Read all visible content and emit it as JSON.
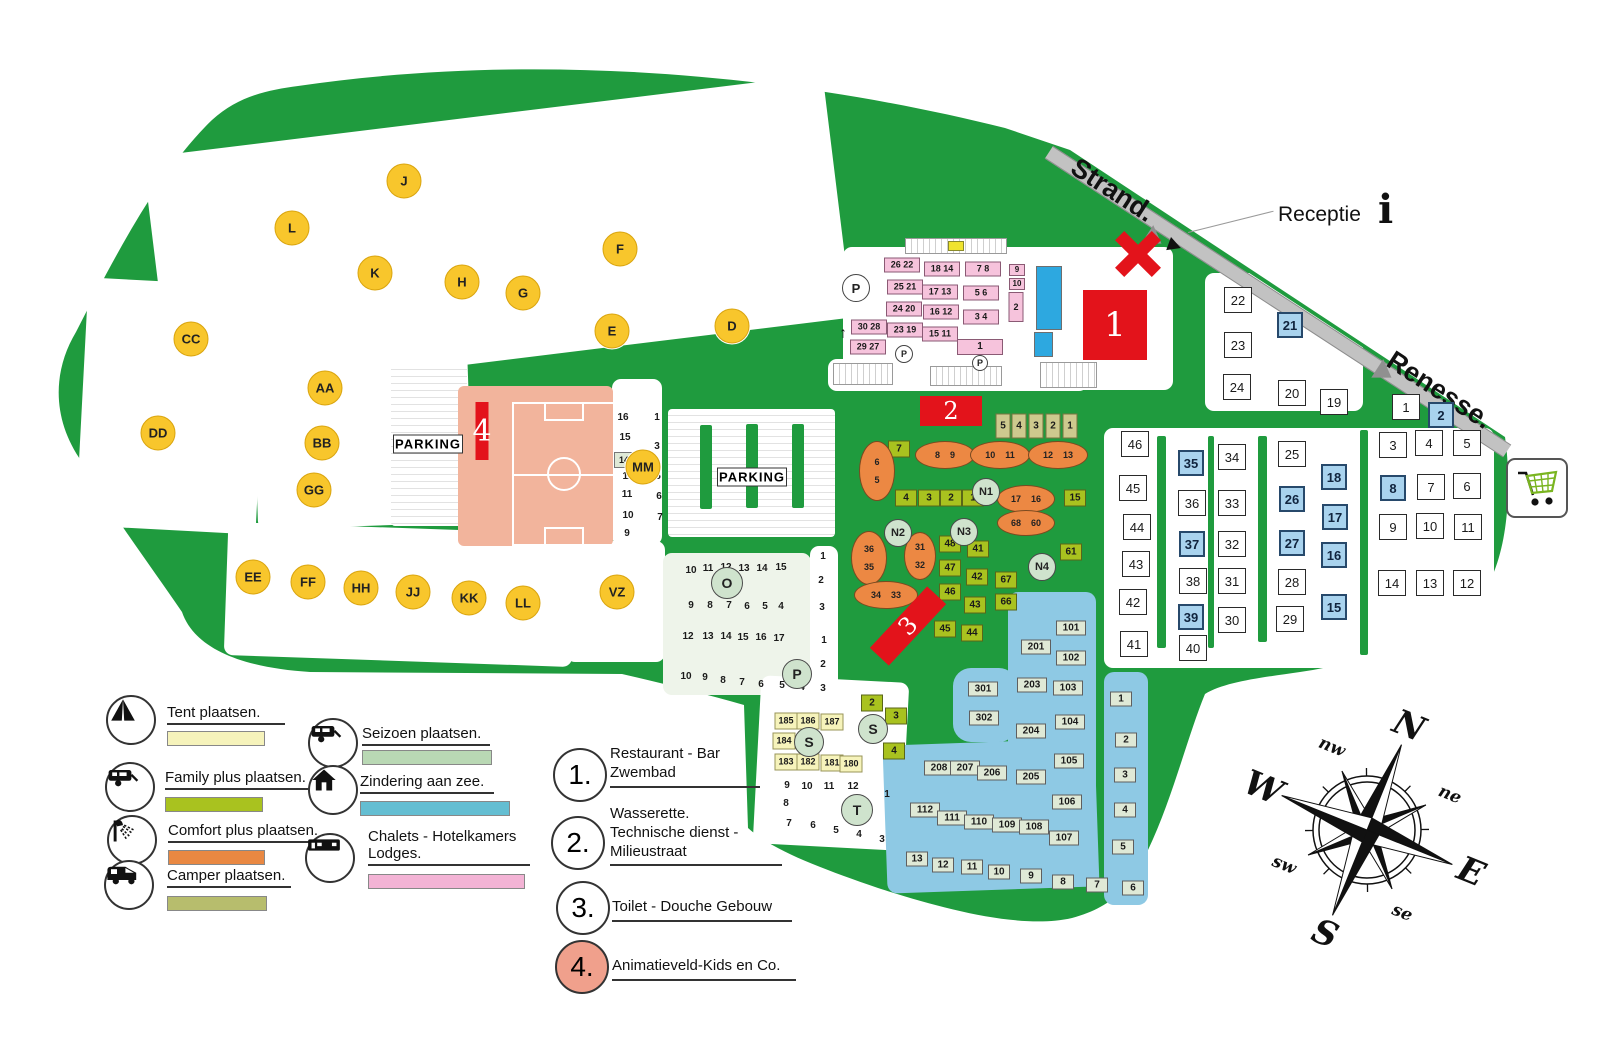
{
  "map": {
    "road_labels": {
      "strand": "Strand.",
      "renesse": "Renesse.",
      "receptie": "Receptie",
      "info_icon": "i"
    },
    "parking_label": "PARKING",
    "up_arrow": "↑",
    "zone_circles": [
      [
        "J",
        404,
        181
      ],
      [
        "L",
        292,
        228
      ],
      [
        "K",
        375,
        273
      ],
      [
        "F",
        620,
        249
      ],
      [
        "H",
        462,
        282
      ],
      [
        "G",
        523,
        293
      ],
      [
        "E",
        612,
        331
      ],
      [
        "D",
        732,
        326
      ],
      [
        "CC",
        191,
        339
      ],
      [
        "AA",
        325,
        388
      ],
      [
        "DD",
        158,
        433
      ],
      [
        "BB",
        322,
        443
      ],
      [
        "GG",
        314,
        490
      ],
      [
        "MM",
        643,
        467
      ],
      [
        "EE",
        253,
        577
      ],
      [
        "FF",
        308,
        582
      ],
      [
        "HH",
        361,
        588
      ],
      [
        "JJ",
        413,
        592
      ],
      [
        "KK",
        469,
        598
      ],
      [
        "LL",
        523,
        603
      ],
      [
        "VZ",
        617,
        592
      ]
    ],
    "green_circles": [
      [
        "O",
        727,
        583,
        30
      ],
      [
        "P",
        797,
        674,
        28
      ],
      [
        "S",
        809,
        742,
        28
      ],
      [
        "S",
        873,
        729,
        28
      ],
      [
        "T",
        857,
        810,
        30
      ],
      [
        "N1",
        986,
        492,
        26
      ],
      [
        "N2",
        898,
        533,
        26
      ],
      [
        "N3",
        964,
        532,
        26
      ],
      [
        "N4",
        1042,
        567,
        26
      ]
    ],
    "white_p_circles": [
      [
        856,
        288,
        26
      ],
      [
        904,
        354,
        16
      ],
      [
        980,
        363,
        14
      ]
    ],
    "plots": [
      [
        "w",
        1238,
        300,
        "22"
      ],
      [
        "w",
        1238,
        345,
        "23"
      ],
      [
        "w",
        1237,
        387,
        "24"
      ],
      [
        "b",
        1290,
        325,
        "21"
      ],
      [
        "w",
        1292,
        393,
        "20"
      ],
      [
        "w",
        1334,
        402,
        "19"
      ],
      [
        "w",
        1406,
        407,
        "1"
      ],
      [
        "b",
        1441,
        415,
        "2"
      ],
      [
        "w",
        1135,
        444,
        "46"
      ],
      [
        "w",
        1133,
        488,
        "45"
      ],
      [
        "w",
        1137,
        527,
        "44"
      ],
      [
        "w",
        1136,
        564,
        "43"
      ],
      [
        "w",
        1133,
        602,
        "42"
      ],
      [
        "w",
        1134,
        644,
        "41"
      ],
      [
        "b",
        1191,
        463,
        "35"
      ],
      [
        "w",
        1192,
        503,
        "36"
      ],
      [
        "b",
        1192,
        544,
        "37"
      ],
      [
        "w",
        1193,
        581,
        "38"
      ],
      [
        "b",
        1191,
        617,
        "39"
      ],
      [
        "w",
        1193,
        648,
        "40"
      ],
      [
        "w",
        1232,
        457,
        "34"
      ],
      [
        "w",
        1232,
        503,
        "33"
      ],
      [
        "w",
        1232,
        544,
        "32"
      ],
      [
        "w",
        1232,
        581,
        "31"
      ],
      [
        "w",
        1232,
        620,
        "30"
      ],
      [
        "w",
        1292,
        454,
        "25"
      ],
      [
        "b",
        1292,
        499,
        "26"
      ],
      [
        "b",
        1292,
        543,
        "27"
      ],
      [
        "w",
        1292,
        582,
        "28"
      ],
      [
        "w",
        1290,
        619,
        "29"
      ],
      [
        "b",
        1334,
        477,
        "18"
      ],
      [
        "b",
        1335,
        517,
        "17"
      ],
      [
        "b",
        1334,
        555,
        "16"
      ],
      [
        "b",
        1334,
        607,
        "15"
      ],
      [
        "w",
        1393,
        445,
        "3"
      ],
      [
        "w",
        1429,
        443,
        "4"
      ],
      [
        "w",
        1467,
        443,
        "5"
      ],
      [
        "b",
        1393,
        488,
        "8"
      ],
      [
        "w",
        1431,
        487,
        "7"
      ],
      [
        "w",
        1467,
        486,
        "6"
      ],
      [
        "w",
        1393,
        527,
        "9"
      ],
      [
        "w",
        1430,
        526,
        "10"
      ],
      [
        "w",
        1468,
        527,
        "11"
      ],
      [
        "w",
        1392,
        583,
        "14"
      ],
      [
        "w",
        1430,
        583,
        "13"
      ],
      [
        "w",
        1467,
        583,
        "12"
      ],
      [
        "z",
        1071,
        628,
        "101"
      ],
      [
        "z",
        1071,
        658,
        "102"
      ],
      [
        "z",
        1068,
        688,
        "103"
      ],
      [
        "z",
        1070,
        722,
        "104"
      ],
      [
        "z",
        1069,
        761,
        "105"
      ],
      [
        "z",
        1067,
        802,
        "106"
      ],
      [
        "z",
        1064,
        838,
        "107"
      ],
      [
        "z",
        1036,
        647,
        "201"
      ],
      [
        "z",
        1032,
        685,
        "203"
      ],
      [
        "z",
        1031,
        731,
        "204"
      ],
      [
        "z",
        1031,
        777,
        "205"
      ],
      [
        "z",
        983,
        689,
        "301"
      ],
      [
        "z",
        984,
        718,
        "302"
      ],
      [
        "z",
        939,
        768,
        "208"
      ],
      [
        "z",
        965,
        768,
        "207"
      ],
      [
        "z",
        992,
        773,
        "206"
      ],
      [
        "z",
        925,
        810,
        "112"
      ],
      [
        "z",
        952,
        818,
        "111"
      ],
      [
        "z",
        979,
        822,
        "110"
      ],
      [
        "z",
        1007,
        825,
        "109"
      ],
      [
        "z",
        1034,
        827,
        "108"
      ],
      [
        "z",
        917,
        859,
        "13"
      ],
      [
        "z",
        943,
        865,
        "12"
      ],
      [
        "z",
        972,
        867,
        "11"
      ],
      [
        "z",
        999,
        872,
        "10"
      ],
      [
        "z",
        1031,
        876,
        "9"
      ],
      [
        "z",
        1063,
        882,
        "8"
      ],
      [
        "z",
        1097,
        885,
        "7"
      ],
      [
        "z",
        1133,
        888,
        "6"
      ],
      [
        "z",
        1121,
        699,
        "1"
      ],
      [
        "z",
        1126,
        740,
        "2"
      ],
      [
        "z",
        1125,
        775,
        "3"
      ],
      [
        "z",
        1125,
        810,
        "4"
      ],
      [
        "z",
        1123,
        847,
        "5"
      ],
      [
        "k",
        902,
        265,
        "26 22"
      ],
      [
        "k",
        905,
        287,
        "25 21"
      ],
      [
        "k",
        904,
        309,
        "24 20"
      ],
      [
        "k",
        905,
        330,
        "23 19"
      ],
      [
        "k",
        869,
        327,
        "30 28"
      ],
      [
        "k",
        868,
        347,
        "29 27"
      ],
      [
        "k",
        942,
        269,
        "18 14"
      ],
      [
        "k",
        940,
        292,
        "17 13"
      ],
      [
        "k",
        941,
        312,
        "16 12"
      ],
      [
        "k",
        940,
        334,
        "15 11"
      ],
      [
        "k",
        983,
        269,
        "7 8"
      ],
      [
        "k",
        981,
        293,
        "5 6"
      ],
      [
        "k",
        981,
        317,
        "3 4"
      ],
      [
        "k1",
        980,
        347,
        "1"
      ],
      [
        "k2",
        1017,
        270,
        "9"
      ],
      [
        "k2",
        1017,
        284,
        "10"
      ],
      [
        "k3",
        1016,
        307,
        "2"
      ],
      [
        "g",
        899,
        449,
        "7"
      ],
      [
        "g",
        906,
        498,
        "4"
      ],
      [
        "g",
        929,
        498,
        "3"
      ],
      [
        "g",
        951,
        498,
        "2"
      ],
      [
        "g",
        973,
        498,
        "1"
      ],
      [
        "g",
        1075,
        498,
        "15"
      ],
      [
        "g",
        1071,
        552,
        "61"
      ],
      [
        "g",
        1006,
        580,
        "67"
      ],
      [
        "g",
        1006,
        602,
        "66"
      ],
      [
        "g",
        950,
        544,
        "48"
      ],
      [
        "g",
        950,
        568,
        "47"
      ],
      [
        "g",
        950,
        592,
        "46"
      ],
      [
        "g",
        978,
        549,
        "41"
      ],
      [
        "g",
        977,
        577,
        "42"
      ],
      [
        "g",
        975,
        605,
        "43"
      ],
      [
        "g",
        972,
        633,
        "44"
      ],
      [
        "g",
        945,
        629,
        "45"
      ],
      [
        "g",
        872,
        703,
        "2"
      ],
      [
        "g",
        896,
        716,
        "3"
      ],
      [
        "g",
        894,
        751,
        "4"
      ],
      [
        "t",
        1003,
        426,
        "5"
      ],
      [
        "t",
        1019,
        426,
        "4"
      ],
      [
        "t",
        1036,
        426,
        "3"
      ],
      [
        "t",
        1053,
        426,
        "2"
      ],
      [
        "t",
        1070,
        426,
        "1"
      ],
      [
        "y",
        786,
        721,
        "185"
      ],
      [
        "y",
        808,
        721,
        "186"
      ],
      [
        "y",
        832,
        722,
        "187"
      ],
      [
        "y",
        784,
        741,
        "184"
      ],
      [
        "y",
        786,
        762,
        "183"
      ],
      [
        "y",
        808,
        762,
        "182"
      ],
      [
        "y",
        832,
        763,
        "181"
      ],
      [
        "y",
        851,
        764,
        "180"
      ],
      [
        "n",
        691,
        571,
        "10"
      ],
      [
        "n",
        708,
        569,
        "11"
      ],
      [
        "n",
        726,
        568,
        "12"
      ],
      [
        "n",
        744,
        569,
        "13"
      ],
      [
        "n",
        762,
        569,
        "14"
      ],
      [
        "n",
        781,
        568,
        "15"
      ],
      [
        "n",
        691,
        606,
        "9"
      ],
      [
        "n",
        710,
        606,
        "8"
      ],
      [
        "n",
        729,
        606,
        "7"
      ],
      [
        "n",
        747,
        607,
        "6"
      ],
      [
        "n",
        765,
        607,
        "5"
      ],
      [
        "n",
        781,
        607,
        "4"
      ],
      [
        "n",
        688,
        637,
        "12"
      ],
      [
        "n",
        708,
        637,
        "13"
      ],
      [
        "n",
        726,
        637,
        "14"
      ],
      [
        "n",
        743,
        638,
        "15"
      ],
      [
        "n",
        761,
        638,
        "16"
      ],
      [
        "n",
        779,
        639,
        "17"
      ],
      [
        "n",
        686,
        677,
        "10"
      ],
      [
        "n",
        705,
        678,
        "9"
      ],
      [
        "n",
        723,
        681,
        "8"
      ],
      [
        "n",
        742,
        683,
        "7"
      ],
      [
        "n",
        761,
        685,
        "6"
      ],
      [
        "n",
        782,
        686,
        "5"
      ],
      [
        "n",
        802,
        688,
        "4"
      ],
      [
        "n",
        823,
        557,
        "1"
      ],
      [
        "n",
        821,
        581,
        "2"
      ],
      [
        "n",
        822,
        608,
        "3"
      ],
      [
        "n",
        824,
        641,
        "1"
      ],
      [
        "n",
        823,
        665,
        "2"
      ],
      [
        "n",
        823,
        689,
        "3"
      ],
      [
        "n",
        787,
        786,
        "9"
      ],
      [
        "n",
        807,
        787,
        "10"
      ],
      [
        "n",
        829,
        787,
        "11"
      ],
      [
        "n",
        853,
        787,
        "12"
      ],
      [
        "n",
        887,
        795,
        "1"
      ],
      [
        "n",
        786,
        804,
        "8"
      ],
      [
        "n",
        789,
        824,
        "7"
      ],
      [
        "n",
        813,
        826,
        "6"
      ],
      [
        "n",
        836,
        831,
        "5"
      ],
      [
        "n",
        859,
        835,
        "4"
      ],
      [
        "n",
        882,
        840,
        "3"
      ],
      [
        "n",
        623,
        418,
        "16"
      ],
      [
        "n",
        625,
        438,
        "15"
      ],
      [
        "n",
        628,
        477,
        "12"
      ],
      [
        "n",
        627,
        495,
        "11"
      ],
      [
        "n",
        628,
        516,
        "10"
      ],
      [
        "n",
        627,
        534,
        "9"
      ],
      [
        "n",
        657,
        418,
        "1"
      ],
      [
        "n",
        657,
        447,
        "3"
      ],
      [
        "n",
        658,
        477,
        "5"
      ],
      [
        "n",
        659,
        497,
        "6"
      ],
      [
        "n",
        660,
        518,
        "7"
      ],
      [
        "s",
        624,
        460,
        "14"
      ]
    ],
    "ovals": [
      [
        877,
        471,
        34,
        58,
        1,
        [
          "6",
          "5"
        ]
      ],
      [
        945,
        455,
        58,
        26,
        0,
        [
          "8",
          "9"
        ]
      ],
      [
        1000,
        455,
        58,
        26,
        0,
        [
          "10",
          "11"
        ]
      ],
      [
        1058,
        455,
        58,
        26,
        0,
        [
          "12",
          "13"
        ]
      ],
      [
        1026,
        499,
        56,
        26,
        0,
        [
          "17",
          "16"
        ]
      ],
      [
        1026,
        523,
        56,
        24,
        0,
        [
          "68",
          "60"
        ]
      ],
      [
        869,
        558,
        34,
        52,
        1,
        [
          "36",
          "35"
        ]
      ],
      [
        920,
        556,
        30,
        46,
        1,
        [
          "31",
          "32"
        ]
      ],
      [
        886,
        595,
        62,
        26,
        0,
        [
          "34",
          "33"
        ]
      ]
    ],
    "buildings": [
      {
        "cx": 1115,
        "cy": 325,
        "w": 64,
        "h": 70,
        "rot": 0,
        "label": "1",
        "fs": 34
      },
      {
        "cx": 951,
        "cy": 411,
        "w": 62,
        "h": 30,
        "rot": 0,
        "label": "2",
        "fs": 24
      },
      {
        "cx": 908,
        "cy": 626,
        "w": 84,
        "h": 26,
        "rot": -47,
        "label": "3",
        "fs": 24
      },
      {
        "cx": 482,
        "cy": 431,
        "w": 13,
        "h": 58,
        "rot": 0,
        "label": "4",
        "fs": 30
      }
    ]
  },
  "legend": {
    "items": [
      {
        "icon": "tent-icon",
        "label": "Tent plaatsen.",
        "color": "#f6f3bb",
        "cx": 131,
        "cy": 720,
        "lx": 167,
        "ly": 704,
        "sx": 167,
        "sy": 731,
        "sw": 96,
        "ul": 118
      },
      {
        "icon": "caravan-icon",
        "label": "Family plus plaatsen.",
        "color": "#a9c21f",
        "cx": 130,
        "cy": 787,
        "lx": 165,
        "ly": 769,
        "sx": 165,
        "sy": 797,
        "sw": 96,
        "ul": 152
      },
      {
        "icon": "shower-icon",
        "label": "Comfort plus plaatsen.",
        "color": "#e98842",
        "cx": 132,
        "cy": 840,
        "lx": 168,
        "ly": 822,
        "sx": 168,
        "sy": 850,
        "sw": 95,
        "ul": 155
      },
      {
        "icon": "camper-icon",
        "label": "Camper plaatsen.",
        "color": "#b7bd6d",
        "cx": 129,
        "cy": 885,
        "lx": 167,
        "ly": 867,
        "sx": 167,
        "sy": 896,
        "sw": 98,
        "ul": 124
      },
      {
        "icon": "caravan-icon",
        "label": "Seizoen plaatsen.",
        "color": "#b9d8b4",
        "cx": 333,
        "cy": 743,
        "lx": 362,
        "ly": 725,
        "sx": 362,
        "sy": 750,
        "sw": 128,
        "ul": 128
      },
      {
        "icon": "house-icon",
        "label": "Zindering aan zee.",
        "color": "#64bed2",
        "cx": 333,
        "cy": 790,
        "lx": 360,
        "ly": 773,
        "sx": 360,
        "sy": 801,
        "sw": 148,
        "ul": 134
      },
      {
        "icon": "lodge-icon",
        "label": "Chalets - Hotelkamers\nLodges.",
        "color": "#f3b3d5",
        "cx": 330,
        "cy": 858,
        "lx": 368,
        "ly": 828,
        "sx": 368,
        "sy": 874,
        "sw": 155,
        "ul": 162
      }
    ],
    "numbered": [
      {
        "num": "1.",
        "lines": "Restaurant - Bar\nZwembad",
        "cx": 580,
        "cy": 775,
        "tx": 610,
        "ty": 745,
        "ul": 150,
        "fill": "#fff"
      },
      {
        "num": "2.",
        "lines": "Wasserette.\nTechnische dienst -\nMilieustraat",
        "cx": 578,
        "cy": 843,
        "tx": 610,
        "ty": 805,
        "ul": 172,
        "fill": "#fff"
      },
      {
        "num": "3.",
        "lines": "Toilet - Douche Gebouw",
        "cx": 583,
        "cy": 908,
        "tx": 612,
        "ty": 898,
        "ul": 180,
        "fill": "#fff"
      },
      {
        "num": "4.",
        "lines": "Animatieveld-Kids en Co.",
        "cx": 582,
        "cy": 967,
        "tx": 612,
        "ty": 957,
        "ul": 184,
        "fill": "#f0a08c"
      }
    ]
  },
  "compass": {
    "cardinal": [
      "N",
      "E",
      "S",
      "W"
    ],
    "intercardinal": [
      "ne",
      "se",
      "sw",
      "nw"
    ],
    "rotation_deg": 22
  },
  "cart": {
    "name": "shopping-cart"
  }
}
